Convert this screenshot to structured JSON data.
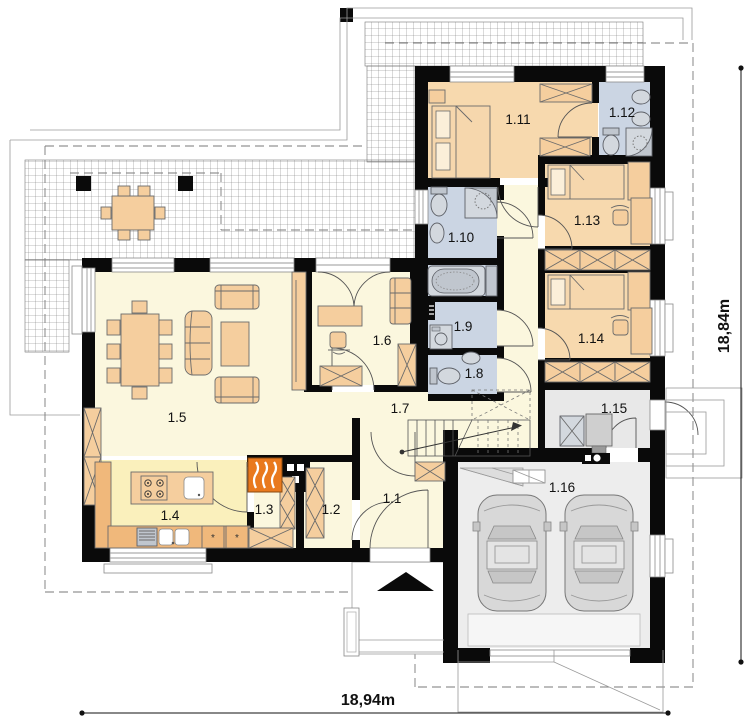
{
  "rooms": {
    "r1_1": {
      "label": "1.1"
    },
    "r1_2": {
      "label": "1.2"
    },
    "r1_3": {
      "label": "1.3"
    },
    "r1_4": {
      "label": "1.4"
    },
    "r1_5": {
      "label": "1.5"
    },
    "r1_6": {
      "label": "1.6"
    },
    "r1_7": {
      "label": "1.7"
    },
    "r1_8": {
      "label": "1.8"
    },
    "r1_9": {
      "label": "1.9"
    },
    "r1_10": {
      "label": "1.10"
    },
    "r1_11": {
      "label": "1.11"
    },
    "r1_12": {
      "label": "1.12"
    },
    "r1_13": {
      "label": "1.13"
    },
    "r1_14": {
      "label": "1.14"
    },
    "r1_15": {
      "label": "1.15"
    },
    "r1_16": {
      "label": "1.16"
    }
  },
  "dimensions": {
    "bottom": "18,94m",
    "right": "18,84m"
  },
  "colors": {
    "wall": "#0a0a0a",
    "floor_living": "#FBF7DE",
    "floor_kitchen": "#FAF0BC",
    "floor_bedroom": "#F7D9AE",
    "floor_bathroom": "#CBD5E3",
    "floor_garage": "#EDEDED",
    "floor_utility": "#E8E8E8",
    "furniture": "#F5CE9E",
    "counter": "#F0B87B",
    "fireplace": "#E9791E",
    "fixture": "#D3D8DE",
    "car": "#D8D8D8"
  }
}
